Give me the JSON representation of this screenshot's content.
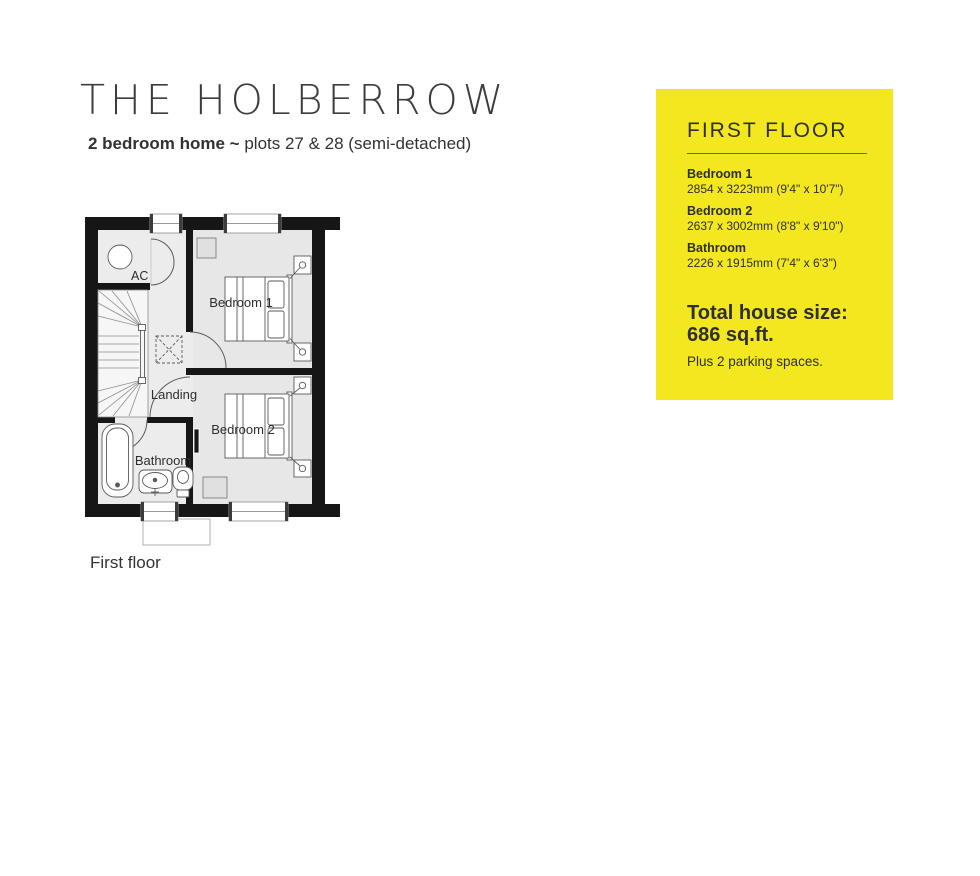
{
  "header": {
    "title": "THE HOLBERROW",
    "subtitle_bold": "2 bedroom home ~",
    "subtitle_regular": " plots 27 & 28 (semi-detached)"
  },
  "floorplan": {
    "caption": "First floor",
    "room_labels": {
      "ac": "AC",
      "bedroom1": "Bedroom 1",
      "bedroom2": "Bedroom 2",
      "landing": "Landing",
      "bathroom": "Bathroom"
    },
    "colors": {
      "wall": "#161616",
      "floor": "#ececec",
      "outline": "#5a5a5a"
    }
  },
  "info_panel": {
    "heading": "FIRST FLOOR",
    "rooms": [
      {
        "name": "Bedroom 1",
        "dims": "2854 x 3223mm (9'4\" x 10'7\")"
      },
      {
        "name": "Bedroom 2",
        "dims": "2637 x 3002mm (8'8\" x 9'10\")"
      },
      {
        "name": "Bathroom",
        "dims": "2226 x 1915mm (7'4\" x 6'3\")"
      }
    ],
    "total_label": "Total house size:",
    "total_value": "686 sq.ft.",
    "parking_note": "Plus 2 parking spaces.",
    "bg_color": "#F3E71F",
    "text_color": "#2f2f2f"
  }
}
